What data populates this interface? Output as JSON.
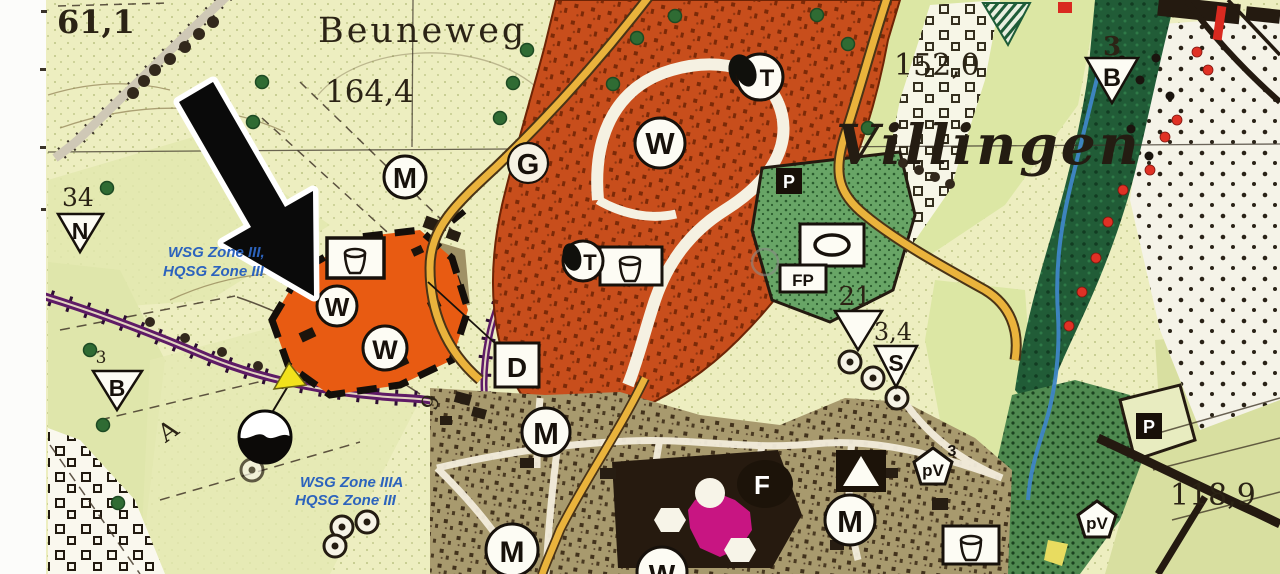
{
  "labels": {
    "street": "Beuneweg",
    "city": "Villingen",
    "elev_61": "61,1",
    "elev_164": "164,4",
    "elev_152": "152,0",
    "elev_118": "118,9",
    "num_34": "34",
    "num_21": "21",
    "num_3_4": "3,4",
    "num_3": "3",
    "num_9": "9",
    "letter_A": "A"
  },
  "zones": {
    "upper_line1": "WSG Zone III,",
    "upper_line2": "HQSG Zone III",
    "lower_line1": "WSG Zone IIIA",
    "lower_line2": "HQSG Zone III"
  },
  "markers": {
    "m": "M",
    "w": "W",
    "g": "G",
    "t": "T",
    "d": "D",
    "s": "S",
    "f": "F",
    "n": "N",
    "b": "B",
    "p": "P",
    "fp": "FP",
    "pv": "pV"
  },
  "colors": {
    "wsg_text_blue": "#2c63bd",
    "highlight_parcel_orange": "#e85b12",
    "built_zone_red": "#c84e1c",
    "built_zone_olive": "#a89a6e",
    "park_green": "#68a566",
    "forest_green": "#215c37",
    "road_yellow": "#eab33c",
    "road_purple": "#5e1b66",
    "stream_blue": "#3f86c6",
    "church_magenta": "#d6158c",
    "marker_yellow": "#f2e21c"
  }
}
